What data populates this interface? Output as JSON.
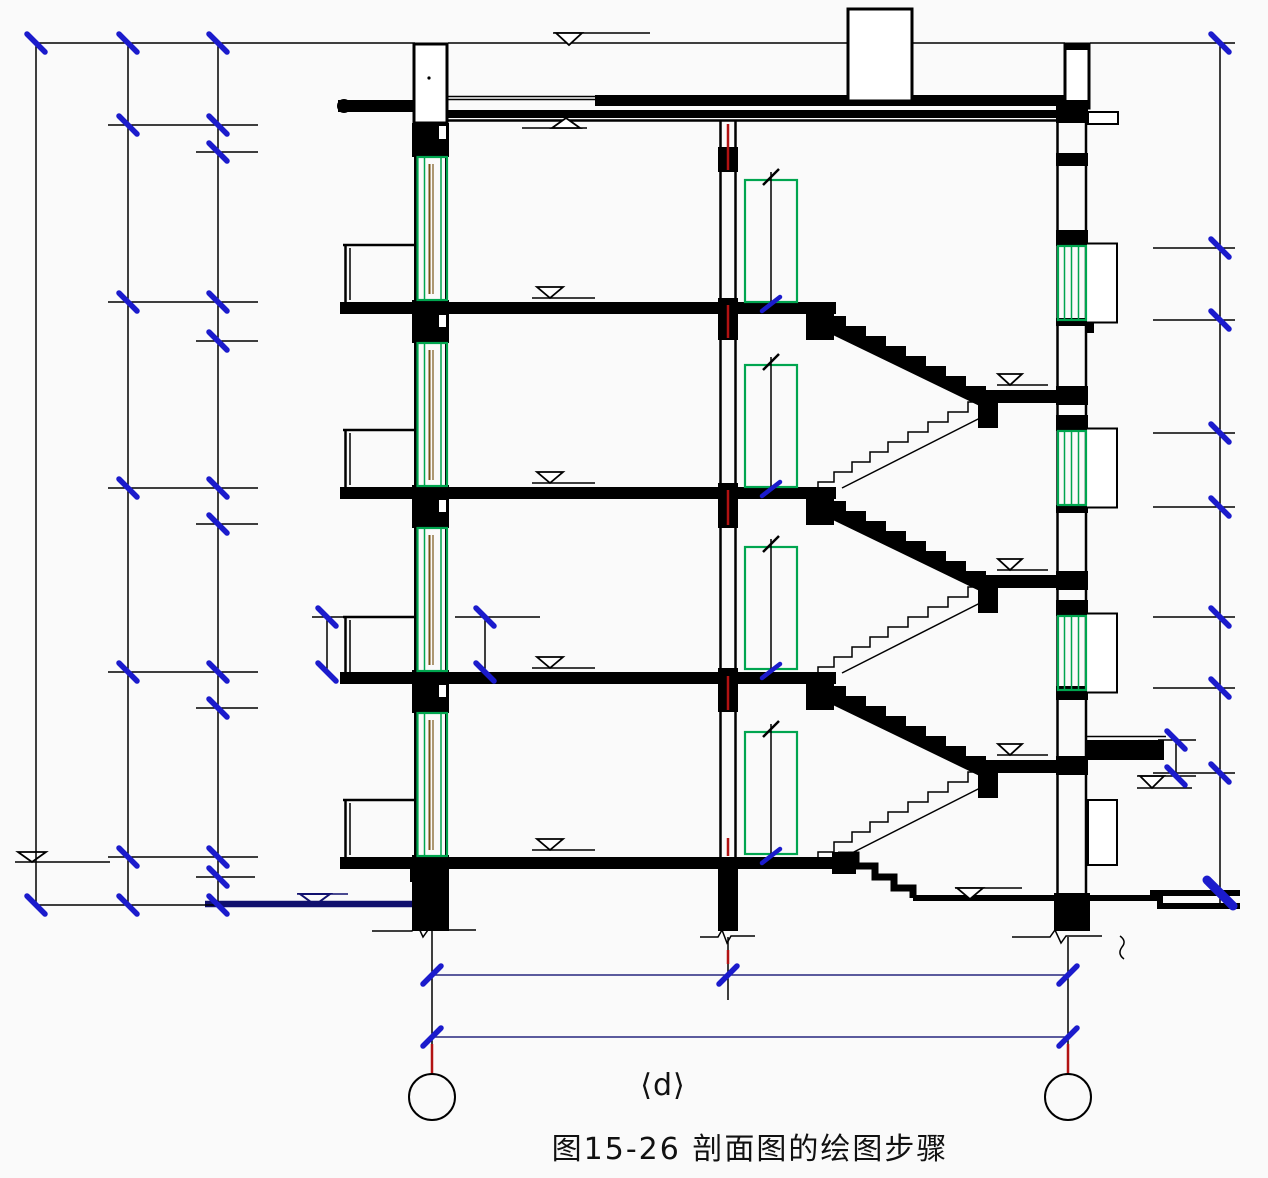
{
  "figure": {
    "panel_label": "⟨d⟩",
    "caption": "图15-26 剖面图的绘图步骤"
  },
  "colors": {
    "line_black": "#000000",
    "dimension_tick_blue": "#1b1bcc",
    "dimension_line_navy": "#26267e",
    "ground_line_navy": "#10106e",
    "axis_red": "#b21212",
    "window_green": "#00a54f",
    "window_sash_brown": "#7a5618",
    "paper_background": "#fafafa"
  }
}
